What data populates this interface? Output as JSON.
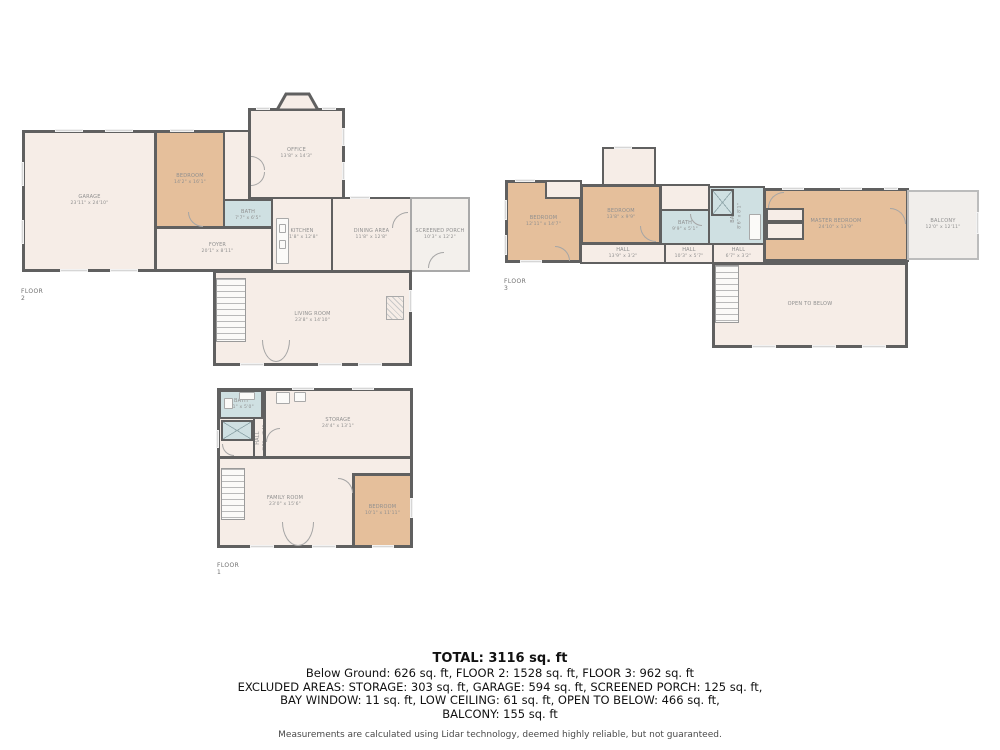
{
  "floor2": {
    "label": "FLOOR 2",
    "rooms": {
      "garage": {
        "name": "GARAGE",
        "dims": "23'11\" x 24'10\""
      },
      "bedroom": {
        "name": "BEDROOM",
        "dims": "14'2\" x 16'1\""
      },
      "office": {
        "name": "OFFICE",
        "dims": "13'8\" x 14'3\""
      },
      "bath": {
        "name": "BATH",
        "dims": "7'7\" x 6'5\""
      },
      "kitchen": {
        "name": "KITCHEN",
        "dims": "11'8\" x 12'8\""
      },
      "dining": {
        "name": "DINING AREA",
        "dims": "11'8\" x 12'8\""
      },
      "foyer": {
        "name": "FOYER",
        "dims": "20'1\" x 8'11\""
      },
      "living": {
        "name": "LIVING ROOM",
        "dims": "23'8\" x 14'10\""
      },
      "porch": {
        "name": "SCREENED PORCH",
        "dims": "10'3\" x 12'2\""
      }
    }
  },
  "floor3": {
    "label": "FLOOR 3",
    "rooms": {
      "bedroom1": {
        "name": "BEDROOM",
        "dims": "12'11\" x 14'7\""
      },
      "bedroom2": {
        "name": "BEDROOM",
        "dims": "13'8\" x 9'9\""
      },
      "bath1": {
        "name": "BATH",
        "dims": "9'9\" x 5'1\""
      },
      "bath2": {
        "name": "BATH",
        "dims": "8'6\" x 8'1\""
      },
      "master": {
        "name": "MASTER BEDROOM",
        "dims": "24'10\" x 13'9\""
      },
      "balcony": {
        "name": "BALCONY",
        "dims": "12'0\" x 12'11\""
      },
      "hall1": {
        "name": "HALL",
        "dims": "13'9\" x 3'2\""
      },
      "hall2": {
        "name": "HALL",
        "dims": "10'3\" x 5'7\""
      },
      "hall3": {
        "name": "HALL",
        "dims": "6'7\" x 3'2\""
      },
      "open": {
        "name": "OPEN TO BELOW",
        "dims": ""
      }
    }
  },
  "floor1": {
    "label": "FLOOR 1",
    "rooms": {
      "bath": {
        "name": "BATH",
        "dims": "8'1\" x 5'0\""
      },
      "storage": {
        "name": "STORAGE",
        "dims": "24'4\" x 13'1\""
      },
      "hall": {
        "name": "HALL",
        "dims": "3'8\" x 7'4\""
      },
      "family": {
        "name": "FAMILY ROOM",
        "dims": "23'0\" x 15'6\""
      },
      "bedroom": {
        "name": "BEDROOM",
        "dims": "10'1\" x 11'11\""
      }
    }
  },
  "summary": {
    "total": "TOTAL: 3116 sq. ft",
    "line1": "Below Ground: 626 sq. ft, FLOOR 2: 1528 sq. ft, FLOOR 3: 962 sq. ft",
    "line2": "EXCLUDED AREAS: STORAGE: 303 sq. ft, GARAGE: 594 sq. ft, SCREENED PORCH: 125 sq. ft,",
    "line3": "BAY WINDOW: 11 sq. ft, LOW CEILING: 61 sq. ft, OPEN TO BELOW: 466 sq. ft,",
    "line4": "BALCONY: 155 sq. ft",
    "disclaimer": "Measurements are calculated using Lidar technology, deemed highly reliable, but not guaranteed."
  },
  "colors": {
    "wall": "#606060",
    "room_fill": "#f6ede7",
    "bedroom_fill": "#e5bf9b",
    "bath_fill": "#cfe0e2",
    "label_text": "#8f8f8f"
  }
}
